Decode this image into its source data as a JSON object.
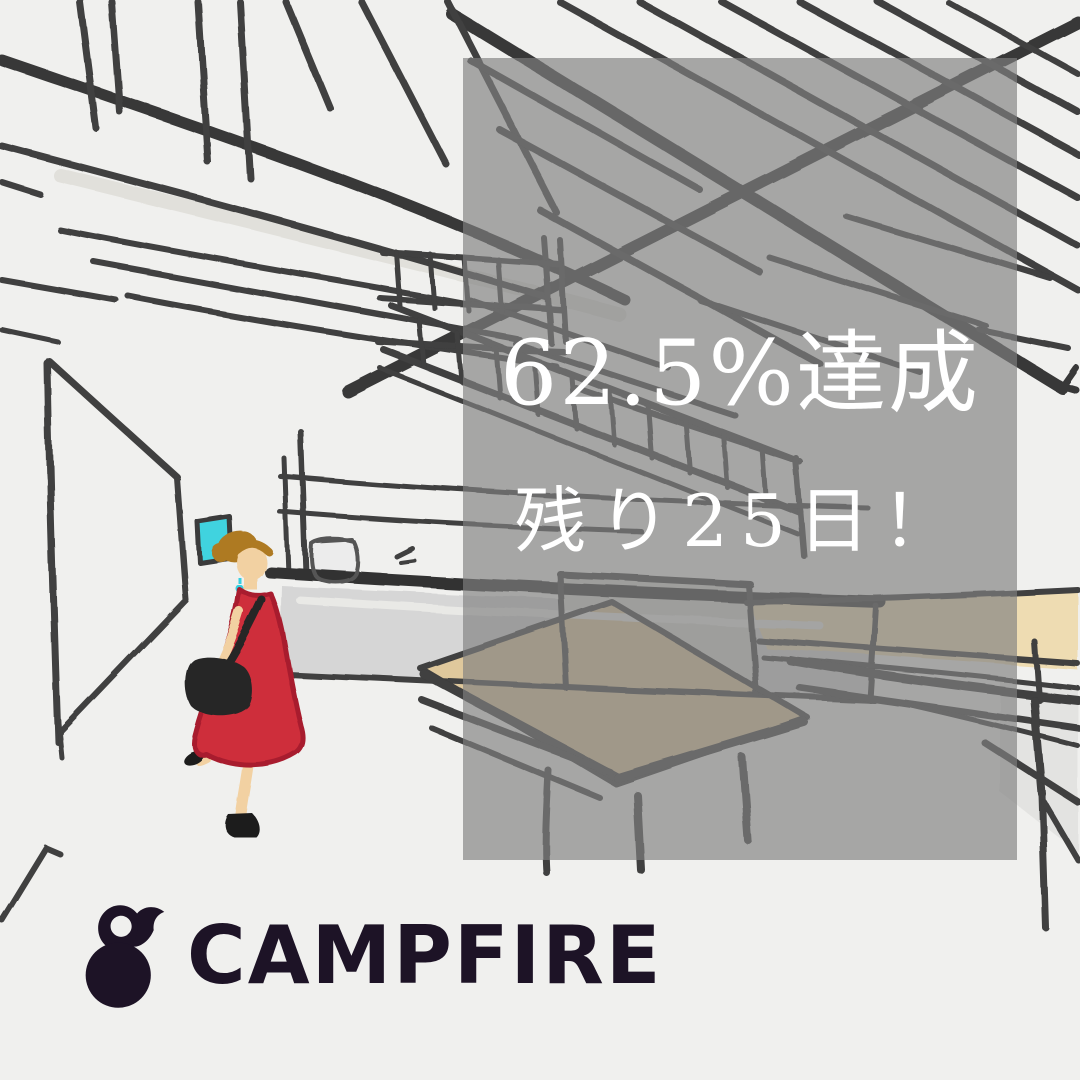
{
  "page": {
    "width": 1080,
    "height": 1080,
    "background": "#f0f0ee"
  },
  "overlay": {
    "line1": "62.5%達成",
    "line2": "残り25日！",
    "progress_percent": 62.5,
    "days_remaining": 25,
    "panel_color_rgba": "rgba(128,128,128,0.66)",
    "text_color": "#ffffff"
  },
  "logo": {
    "wordmark": "CAMPFIRE",
    "color": "#1d1326",
    "icon": "campfire-flame-icon"
  },
  "illustration": {
    "description": "Hand-drawn crayon sketch of a cafe interior: exposed ceiling rafters and two crossing beams, a left corridor wall with a cyan picture frame, a service counter with a glass jar, long wooden tables with benches, and a woman in a red sleeveless dress with a black shoulder bag walking toward the viewer.",
    "colors": {
      "background": "#f0f0ee",
      "sketch_line": "#3f3f3f",
      "dress_red": "#ce2f3b",
      "dress_edge_red": "#a81f2e",
      "skin": "#f2d1a2",
      "hair_brown": "#ae7a22",
      "frame_cyan": "#3fd3df",
      "counter_gray": "#d6d6d6",
      "table_tan": "#dfc89c",
      "table_tan_bright": "#eedcb2"
    }
  }
}
